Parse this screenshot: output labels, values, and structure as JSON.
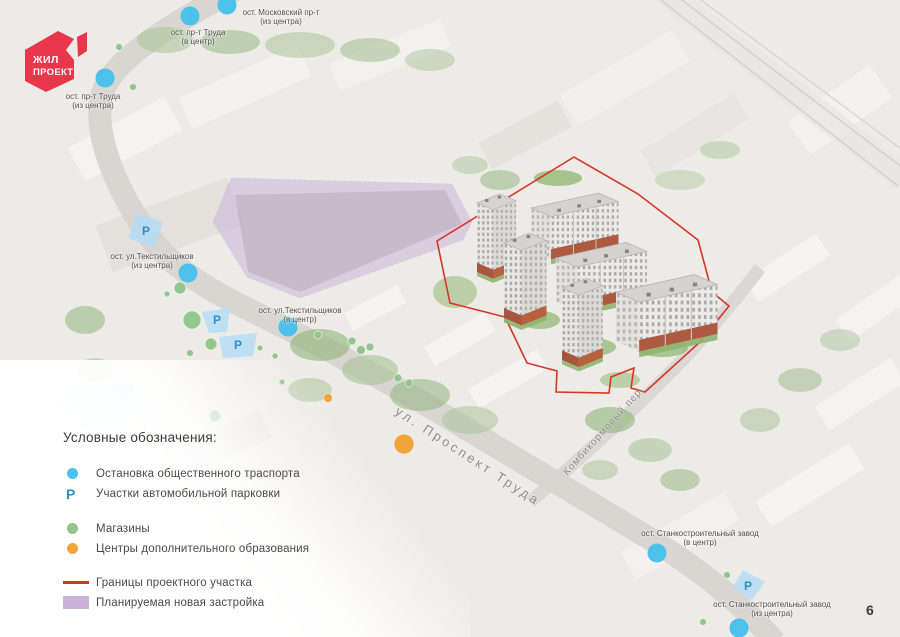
{
  "page": {
    "number": "6"
  },
  "logo": {
    "line1": "ЖИЛ",
    "line2": "ПРОЕКТ",
    "color": "#e8374a"
  },
  "colors": {
    "transit": "#4cc1ec",
    "shops": "#92c68c",
    "education": "#f2a43c",
    "boundary": "#d93425",
    "development": "#c9b3da",
    "parking_fill": "#b5dcf4",
    "parking_letter": "#2f8dcb"
  },
  "legend": {
    "title": "Условные обозначения:",
    "items": [
      {
        "id": "transit",
        "label": "Остановка общественного траспорта",
        "marker": "dot",
        "color": "#4cc1ec",
        "gap": false
      },
      {
        "id": "parking",
        "label": "Участки автомобильной парковки",
        "marker": "P",
        "color": "#2f8dcb",
        "gap": false
      },
      {
        "id": "shops",
        "label": "Магазины",
        "marker": "dot",
        "color": "#92c68c",
        "gap": true
      },
      {
        "id": "education",
        "label": "Центры дополнительного образования",
        "marker": "dot",
        "color": "#f2a43c",
        "gap": false
      },
      {
        "id": "boundary",
        "label": "Границы проектного участка",
        "marker": "line",
        "color": "#d93425",
        "gap": true
      },
      {
        "id": "development",
        "label": "Планируемая новая застройка",
        "marker": "area",
        "color": "#c9b3da",
        "gap": false
      }
    ]
  },
  "map": {
    "street_labels": [
      {
        "text": "ул. Проспект Труда",
        "x": 468,
        "y": 456,
        "rotate": 33,
        "size": 13,
        "spacing": 3
      },
      {
        "text": "Комбикормовый пер.",
        "x": 604,
        "y": 431,
        "rotate": -48,
        "size": 10,
        "spacing": 1
      }
    ],
    "bus_stops": [
      {
        "name": "ост. Московский пр-т",
        "sub": "(из центра)",
        "x": 227,
        "y": 5,
        "label_x": 281,
        "label_y": 8
      },
      {
        "name": "ост. пр-т Труда",
        "sub": "(в центр)",
        "x": 190,
        "y": 16,
        "label_x": 198,
        "label_y": 28
      },
      {
        "name": "ост. пр-т Труда",
        "sub": "(из центра)",
        "x": 105,
        "y": 78,
        "label_x": 93,
        "label_y": 92
      },
      {
        "name": "ост. ул.Текстильщиков",
        "sub": "(из центра)",
        "x": 188,
        "y": 273,
        "label_x": 152,
        "label_y": 252
      },
      {
        "name": "ост. ул.Текстильщиков",
        "sub": "(в центр)",
        "x": 288,
        "y": 327,
        "label_x": 300,
        "label_y": 306
      },
      {
        "name": "ост. Станкостроительный завод",
        "sub": "(в центр)",
        "x": 657,
        "y": 553,
        "label_x": 700,
        "label_y": 529
      },
      {
        "name": "ост. Станкостроительный завод",
        "sub": "(из центра)",
        "x": 739,
        "y": 628,
        "label_x": 772,
        "label_y": 600
      }
    ],
    "parkings": [
      {
        "points": "137,213 163,222 155,248 128,238",
        "px": 146,
        "py": 231
      },
      {
        "points": "202,312 230,308 227,332 209,333",
        "px": 217,
        "py": 320
      },
      {
        "points": "219,337 257,333 253,356 223,358",
        "px": 238,
        "py": 345
      },
      {
        "points": "58,390 135,381 128,425 55,420",
        "px": 88,
        "py": 401
      },
      {
        "points": "743,570 765,582 752,600 733,587",
        "px": 748,
        "py": 586
      }
    ],
    "shops": [
      {
        "x": 119,
        "y": 47,
        "r": 3.5
      },
      {
        "x": 133,
        "y": 87,
        "r": 3.5
      },
      {
        "x": 180,
        "y": 288,
        "r": 6
      },
      {
        "x": 167,
        "y": 294,
        "r": 3
      },
      {
        "x": 192,
        "y": 320,
        "r": 9
      },
      {
        "x": 211,
        "y": 344,
        "r": 6
      },
      {
        "x": 190,
        "y": 353,
        "r": 3.5
      },
      {
        "x": 260,
        "y": 348,
        "r": 3
      },
      {
        "x": 275,
        "y": 356,
        "r": 3
      },
      {
        "x": 282,
        "y": 382,
        "r": 3
      },
      {
        "x": 215,
        "y": 416,
        "r": 6
      },
      {
        "x": 318,
        "y": 335,
        "r": 4
      },
      {
        "x": 352,
        "y": 341,
        "r": 4
      },
      {
        "x": 361,
        "y": 350,
        "r": 4.5
      },
      {
        "x": 370,
        "y": 347,
        "r": 4
      },
      {
        "x": 398,
        "y": 378,
        "r": 4
      },
      {
        "x": 409,
        "y": 383,
        "r": 4
      },
      {
        "x": 727,
        "y": 575,
        "r": 3.5
      },
      {
        "x": 703,
        "y": 622,
        "r": 3.5
      }
    ],
    "education": [
      {
        "x": 404,
        "y": 444,
        "r": 10
      },
      {
        "x": 328,
        "y": 398,
        "r": 4.5
      }
    ]
  }
}
